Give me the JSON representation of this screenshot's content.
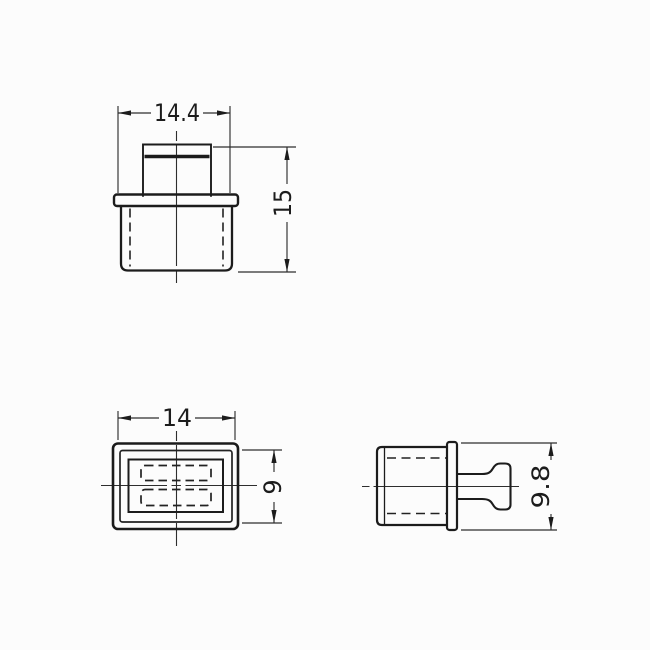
{
  "colors": {
    "background": "#fcfcfc",
    "line": "#1c1c1c"
  },
  "views": {
    "front": {
      "dim_width": "14.4",
      "dim_height": "15"
    },
    "top": {
      "dim_width": "14",
      "dim_depth": "9"
    },
    "side": {
      "dim_height": "9.8"
    }
  }
}
